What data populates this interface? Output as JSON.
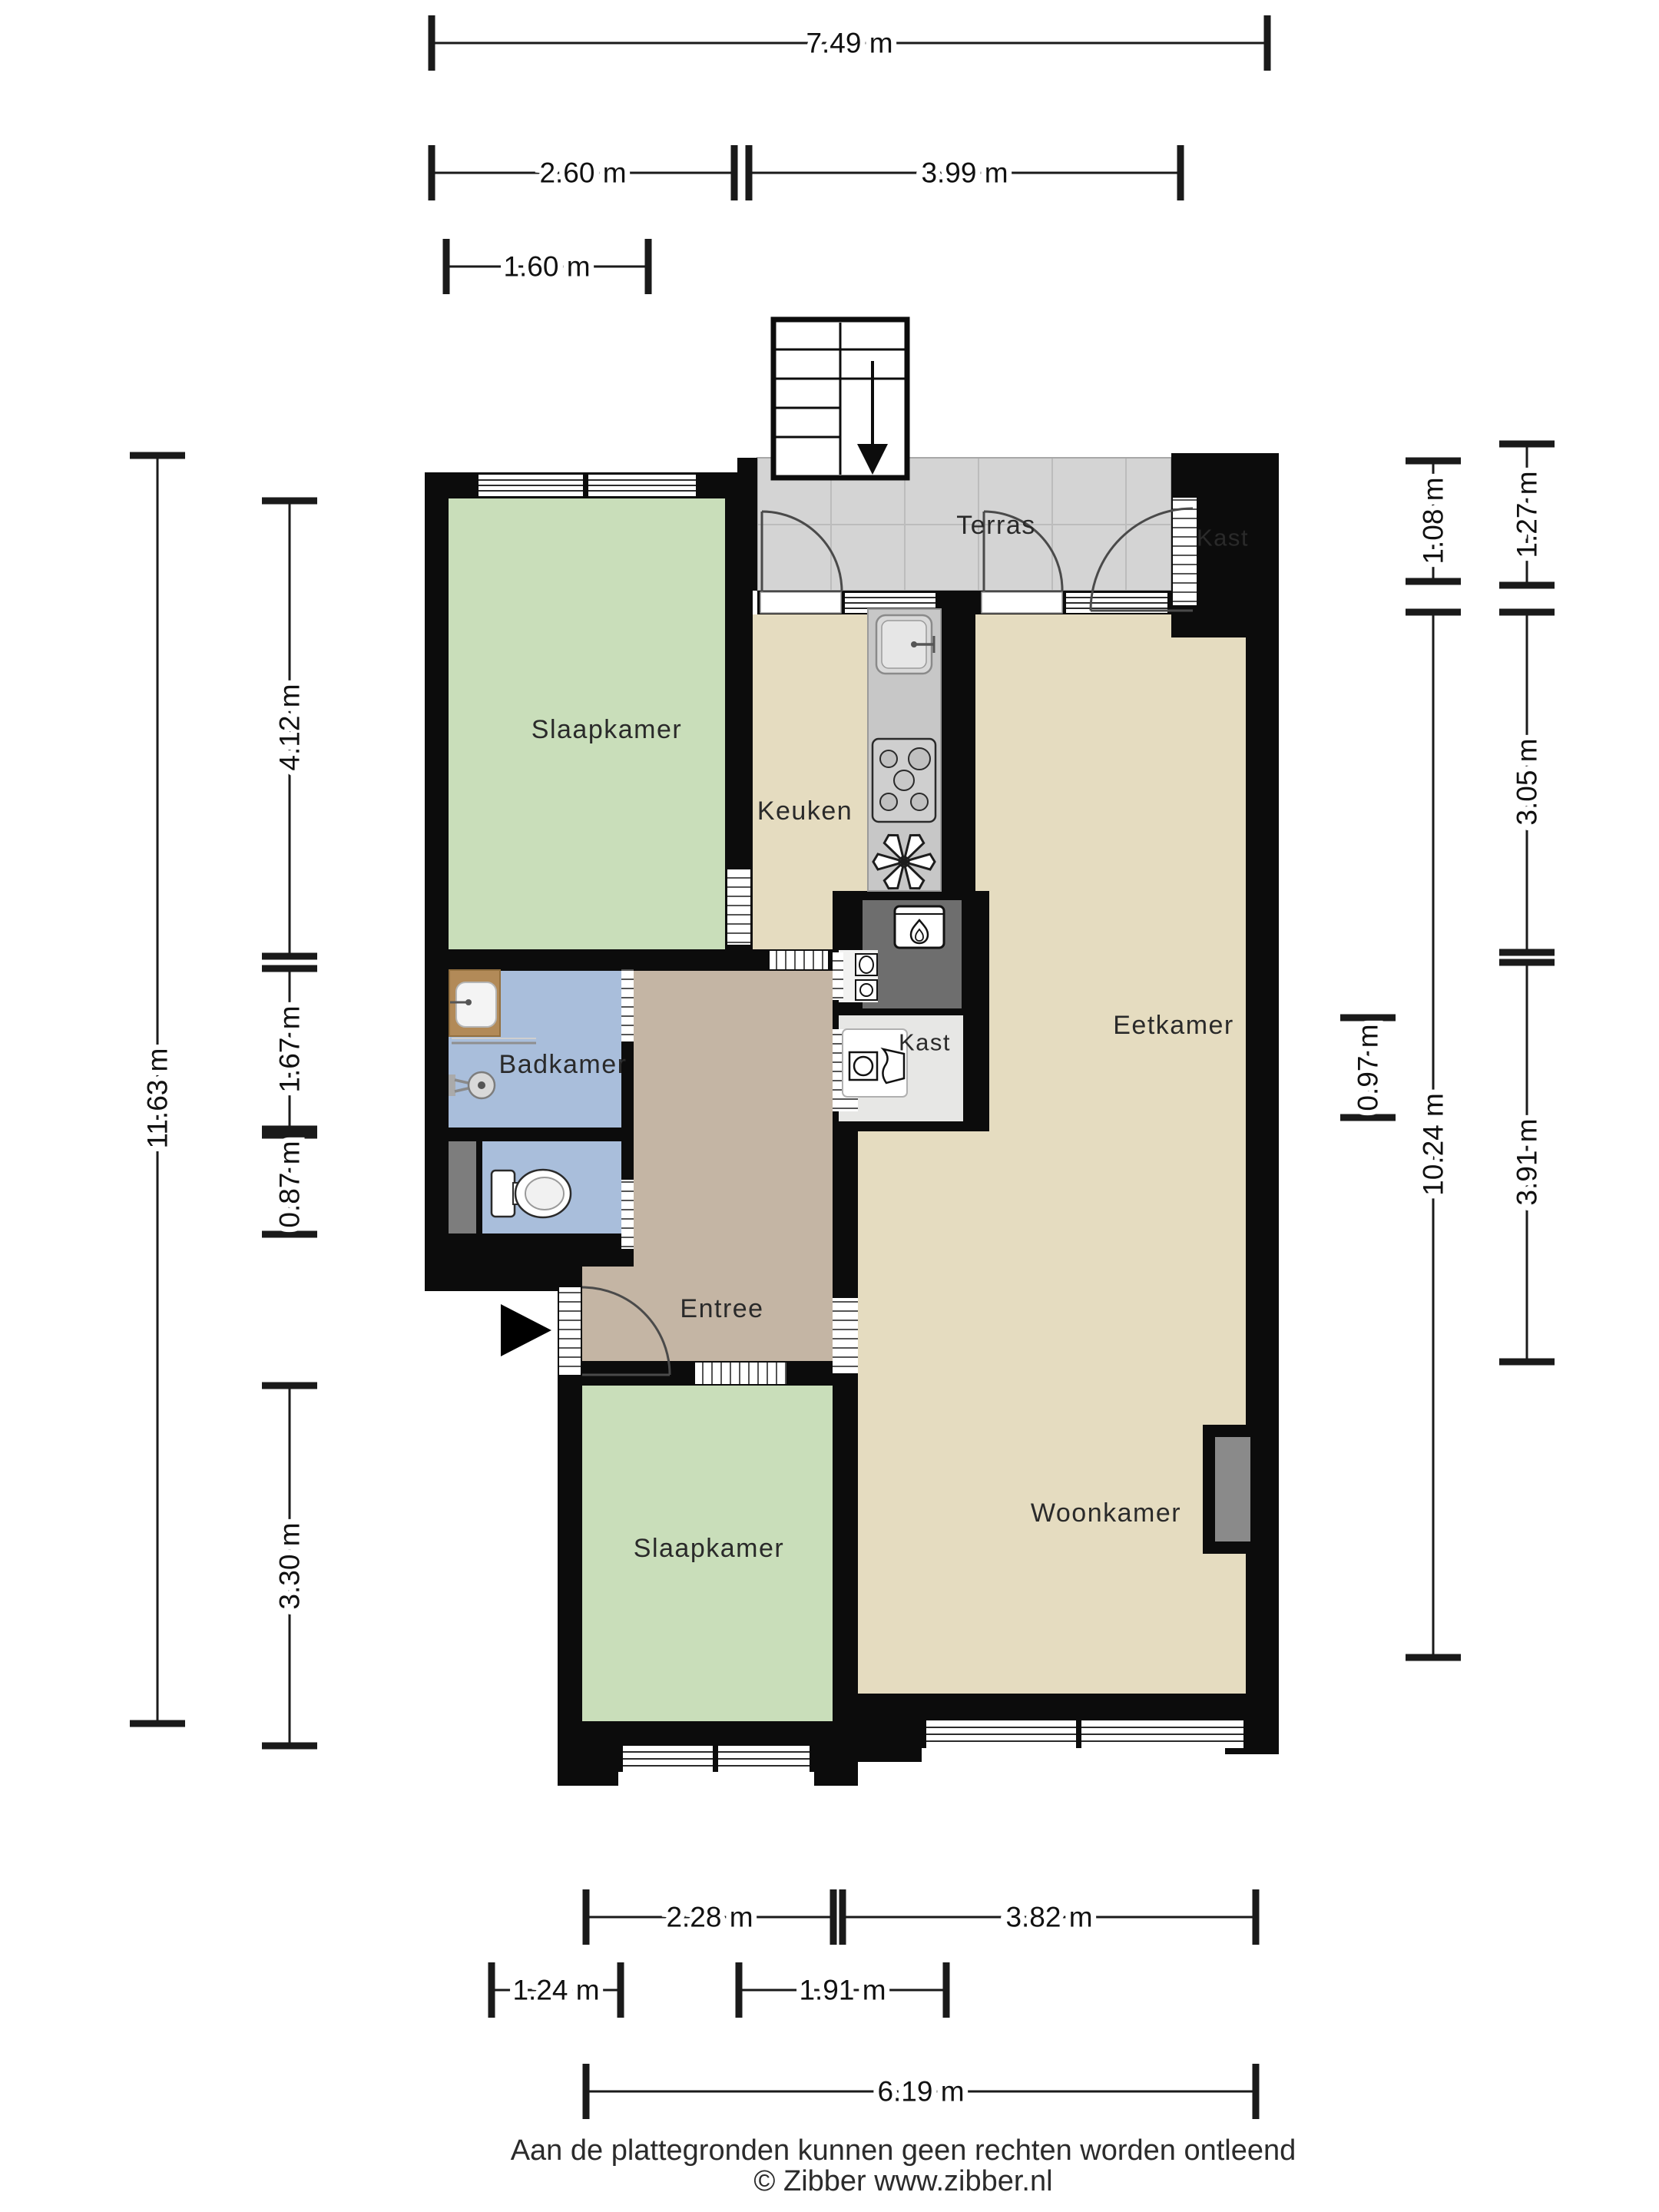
{
  "rooms": {
    "slaapkamer_top": "Slaapkamer",
    "keuken": "Keuken",
    "terras": "Terras",
    "kast_top": "Kast",
    "eetkamer": "Eetkamer",
    "badkamer": "Badkamer",
    "kast_middle": "Kast",
    "entree": "Entree",
    "woonkamer": "Woonkamer",
    "slaapkamer_bottom": "Slaapkamer"
  },
  "dims": {
    "w_total_top": "7.49 m",
    "w_left_top": "2.60 m",
    "w_right_top": "3.99 m",
    "w_inner_top": "1.60 m",
    "h_total_left": "11.63 m",
    "h_slaapkamer_left": "4.12 m",
    "h_badkamer_left": "1.67 m",
    "h_toilet_left": "0.87 m",
    "h_slaapkamer2_left": "3.30 m",
    "h_terras_right": "1.08 m",
    "h_terras_outer_right": "1.27 m",
    "h_eetkamer_right": "3.05 m",
    "h_total_right": "10.24 m",
    "h_mid_right": "0.97 m",
    "h_woonkamer_right": "3.91 m",
    "w_slaapkamer2_bottom": "2.28 m",
    "w_woonkamer_bottom": "3.82 m",
    "w_door_bottom": "1.24 m",
    "w_entree_bottom": "1.91 m",
    "w_total_bottom": "6.19 m"
  },
  "footer": {
    "disclaimer": "Aan de plattegronden kunnen geen rechten worden ontleend",
    "credit": "© Zibber www.zibber.nl"
  },
  "colors": {
    "wall": "#0c0c0c",
    "room_green": "#c9deba",
    "room_beige": "#e5dcc0",
    "room_blue": "#a9bedb",
    "room_tan": "#c4b5a4",
    "terras_gray": "#d4d4d4",
    "kast_gray": "#e7e7e5",
    "closet_white": "#f2f2f1",
    "shaft_gray": "#6e6e6e",
    "counter_gray": "#c7c7c7",
    "wood_counter": "#b28a58",
    "niche_gray": "#8a8a8a"
  },
  "icons": [
    "stairs-down-arrow-icon",
    "entrance-arrow-icon",
    "sink-icon",
    "stove-icon",
    "extractor-fan-icon",
    "boiler-flame-icon",
    "washer-icon",
    "toilet-icon",
    "shower-mixer-icon",
    "bathroom-sink-icon",
    "meter-icons"
  ]
}
